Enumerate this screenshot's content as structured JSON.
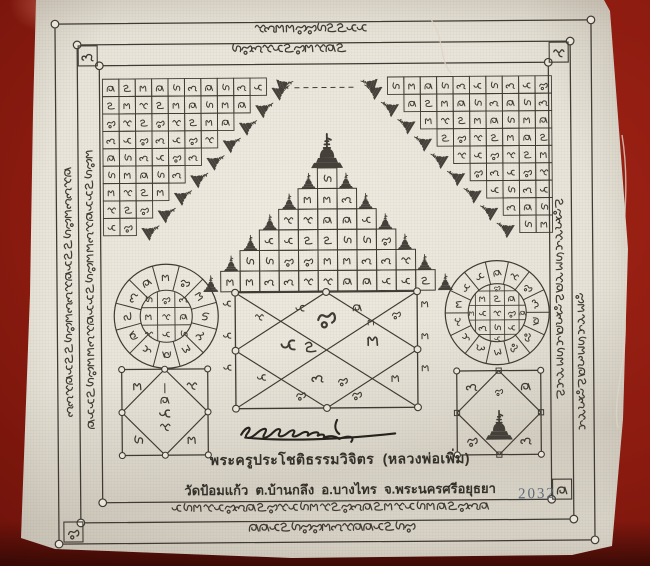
{
  "scene": {
    "background_color": "#8c1b10",
    "cloth_color": "#e9e5da",
    "ink_color": "#3f3a33",
    "stamp_color": "#5f6a7a"
  },
  "borders": {
    "script": "Khom (sacred Pali script, hand-printed)",
    "top_line_glyphs": [
      11,
      11
    ],
    "bottom_line_glyphs": [
      30,
      16
    ],
    "left_column_glyphs": [
      24,
      27
    ],
    "right_column_glyphs": [
      19,
      13
    ],
    "corner_glyph_cells": 4
  },
  "panels": {
    "left_grid": {
      "rows": 9,
      "top_row_cells": 10,
      "stupas_on_steps": 9
    },
    "right_grid": {
      "rows": 9,
      "top_row_cells": 10,
      "stupas_on_steps": 9
    },
    "pyramid": {
      "row_cells": [
        1,
        3,
        5,
        7,
        9,
        11
      ],
      "top_stupa": 1,
      "step_stupas": 12
    },
    "left_wheel": {
      "outer_segments": 12,
      "inner_grid": "3x3"
    },
    "right_wheel": {
      "outer_segments": 14,
      "inner_grid": "4x4"
    },
    "center_yantra": {
      "shape": "rectangle-with-diagonals-and-diamond",
      "node_circles": 8
    },
    "bottom_left_yantra": {
      "shape": "square-with-inscribed-diamond",
      "center": "khom-stack"
    },
    "bottom_right_yantra": {
      "shape": "square-with-inscribed-diamond",
      "center": "stupa"
    }
  },
  "caption": {
    "line1": "พระครูประโชติธรรมวิจิตร  (หลวงพ่อเพิ่ม)",
    "line2": "วัดป้อมแก้ว  ต.บ้านกลึง  อ.บางไทร  จ.พระนครศรีอยุธยา"
  },
  "stamp_number": "2032"
}
